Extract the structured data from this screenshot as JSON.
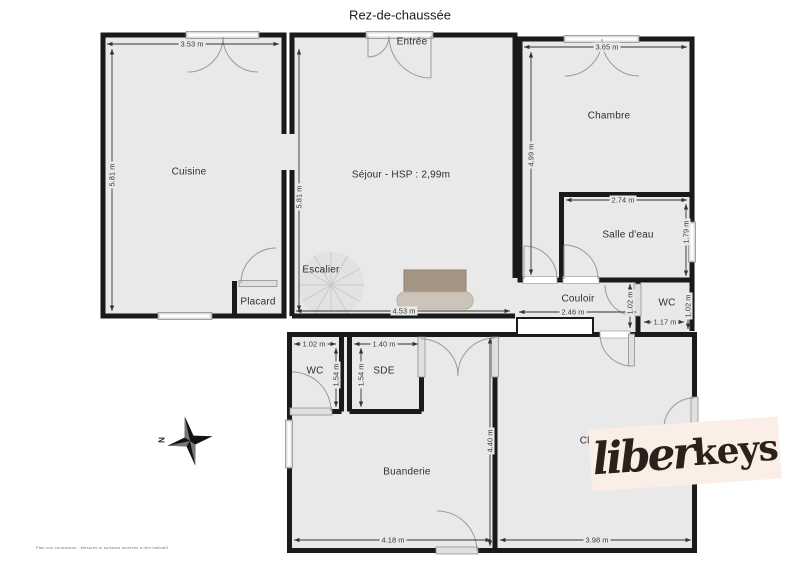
{
  "title": "Rez-de-chaussée",
  "rooms": {
    "cuisine": {
      "label": "Cuisine",
      "width": "3.53 m",
      "height": "5.81 m"
    },
    "sejour": {
      "label": "Séjour - HSP : 2,99m",
      "width": "4.53 m",
      "height": "5.81 m"
    },
    "entree": {
      "label": "Entrée"
    },
    "escalier": {
      "label": "Escalier"
    },
    "placard": {
      "label": "Placard"
    },
    "chambre_haut": {
      "label": "Chambre",
      "width": "3.65 m",
      "height": "4.99 m"
    },
    "salle_eau": {
      "label": "Salle d'eau",
      "width": "2.74 m",
      "height": "1.79 m"
    },
    "couloir": {
      "label": "Couloir",
      "width": "2.46 m",
      "door_height": "1.02 m"
    },
    "wc_haut": {
      "label": "WC",
      "width": "1.17 m",
      "height": "1.02 m"
    },
    "wc_bas": {
      "label": "WC",
      "width": "1.02 m",
      "height": "1.54 m"
    },
    "sde": {
      "label": "SDE",
      "width": "1.40 m",
      "height": "1.54 m"
    },
    "buanderie": {
      "label": "Buanderie",
      "width": "4.18 m",
      "height": "4.40 m"
    },
    "chambre_bas": {
      "label": "Chambre",
      "width": "3.98 m"
    }
  },
  "compass": {
    "north_label": "N"
  },
  "logo": {
    "part1": "liber",
    "part2": "keys"
  },
  "footer": {
    "disclaimer": "Plan non contractuel - Mesures et surfaces données à titre indicatif"
  },
  "colors": {
    "wall": "#1a1a1a",
    "room_fill": "#e9e9e9",
    "logo_bg": "#fbeee7",
    "logo_text": "#2a211b"
  }
}
